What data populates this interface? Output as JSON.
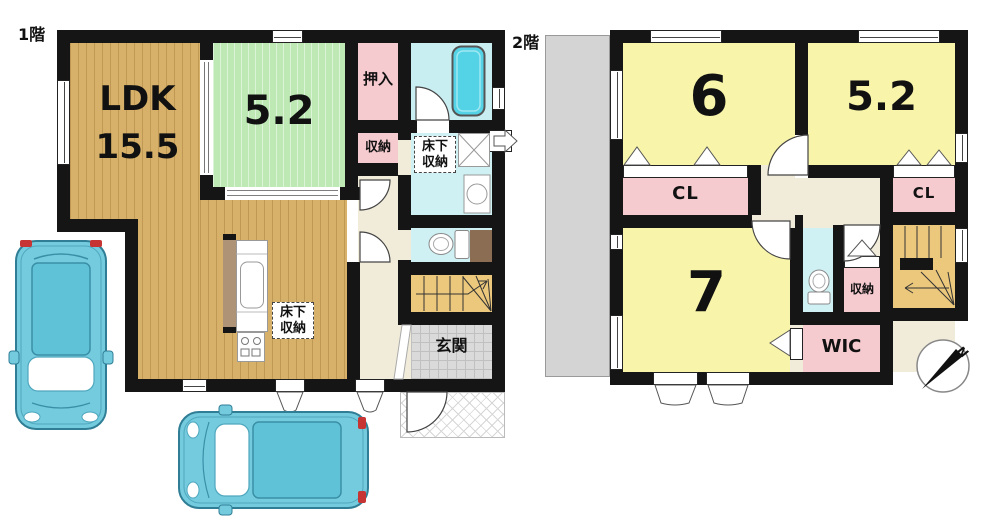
{
  "floor1": {
    "label": "1階",
    "ldk_name": "LDK",
    "ldk_area": "15.5",
    "tatami_room_area": "5.2",
    "oshiire_label": "押入",
    "storage_label": "収納",
    "underfloor_storage_label": "床下収納",
    "underfloor_storage_label_2": "床下収納",
    "entrance_label": "玄関"
  },
  "floor2": {
    "label": "2階",
    "room6_area": "6",
    "room52_area": "5.2",
    "room7_area": "7",
    "closet_label_1": "CL",
    "closet_label_2": "CL",
    "storage_label": "収納",
    "wic_label": "WIC"
  },
  "compass": {
    "north_label": "N"
  },
  "colors": {
    "wood_floor": "#D7B169",
    "tatami_green": "#BEE9B5",
    "room_yellow": "#F8F4AA",
    "closet_pink": "#F5CBD0",
    "bath_cyan": "#C9EEF2",
    "water_cyan": "#CFF1F3",
    "hall_cream": "#F1ECDA",
    "stairs_tan": "#ECC87C",
    "car_cyan": "#74CBDE",
    "wall_black": "#151515"
  }
}
